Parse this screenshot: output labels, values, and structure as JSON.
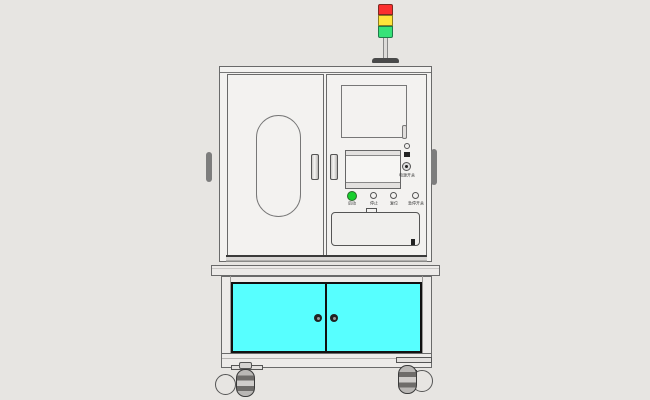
{
  "scene": {
    "background": "#e7e5e2",
    "body_fill": "#f3f2f0",
    "line_color": "#6a6a6a"
  },
  "tower_light": {
    "red": "#fb2f2f",
    "yellow": "#ffe43a",
    "green": "#36e278",
    "pole_fill": "#dddbd9",
    "base_fill": "#4a4a4a"
  },
  "control_panel": {
    "switch_label": "电源开关",
    "buttons": [
      {
        "label": "启动",
        "color": "#17cf2d"
      },
      {
        "label": "停止",
        "color": "#f2f1ef"
      },
      {
        "label": "复位",
        "color": "#f2f1ef"
      },
      {
        "label": "急停开关",
        "color": "#f2f1ef"
      }
    ]
  },
  "lower_cabinet": {
    "door_color": "#57ffff",
    "frame_color": "#111111"
  }
}
